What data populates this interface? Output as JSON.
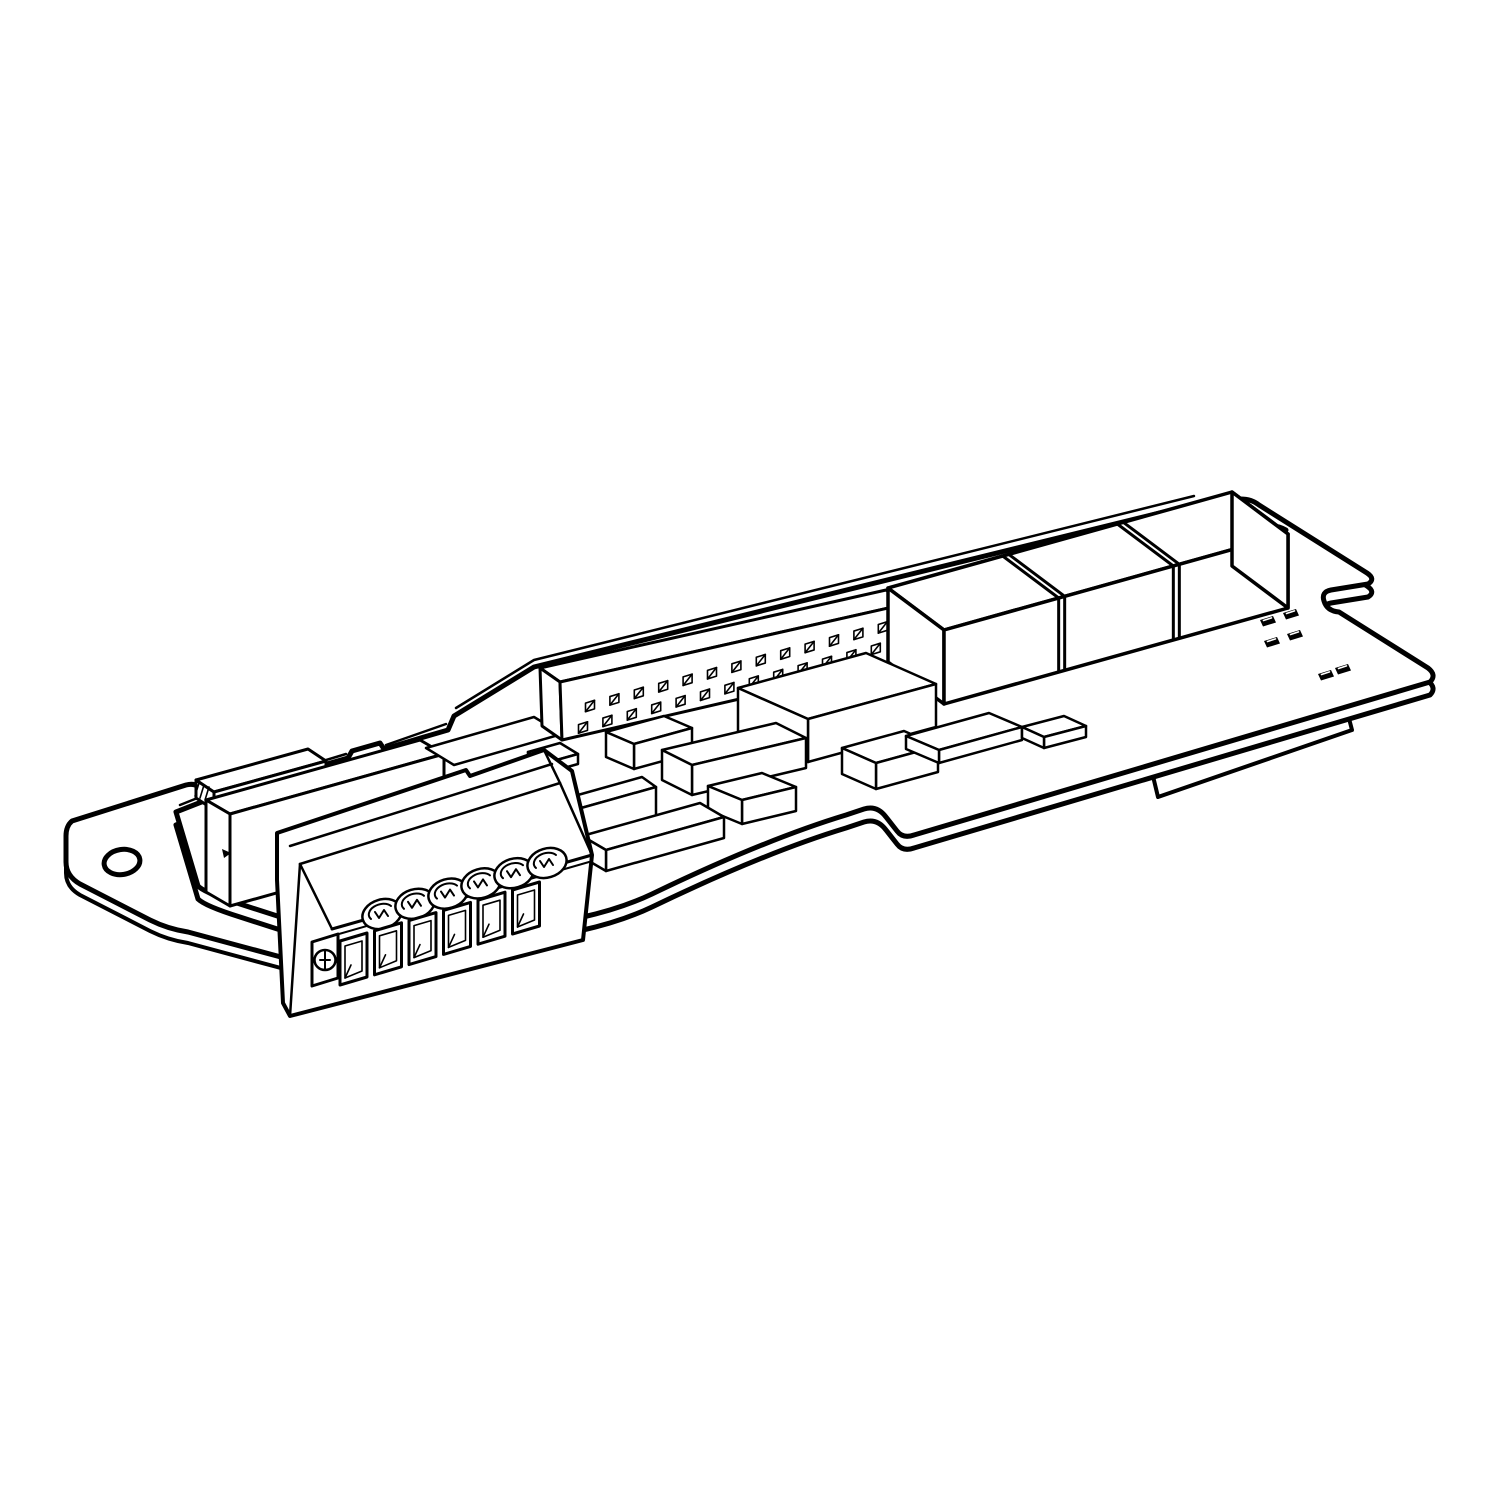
{
  "canvas": {
    "width": 1500,
    "height": 1500,
    "background": "#ffffff"
  },
  "drawing": {
    "type": "technical-line-illustration",
    "subject": "Plug-in option card: printed circuit board with screw terminal block, dual-row pin header, component row and mounting ear",
    "stroke_color": "#000000",
    "fill_color": "#ffffff"
  },
  "parts": {
    "board": {
      "label": "pcb-board",
      "mounting_holes": 2,
      "edge_notches": 2,
      "bottom_edge_tab": 1
    },
    "mounting_ear": {
      "label": "mounting-ear",
      "hole_count": 1
    },
    "terminal_block": {
      "label": "screw-terminal-block",
      "screw_count": 6,
      "window_count": 6,
      "release_screw_count": 1
    },
    "pin_header": {
      "label": "dual-row-pin-header",
      "rows": 2,
      "columns": 13
    },
    "component_row": {
      "label": "relay-component-row",
      "count": 3
    },
    "smd_chips": {
      "label": "smd-components",
      "count": 10
    },
    "silkscreen_marks": {
      "label": "silkscreen-marks",
      "positions": [
        [
          1260,
          620
        ],
        [
          1283,
          613
        ],
        [
          1264,
          641
        ],
        [
          1287,
          634
        ],
        [
          1318,
          674
        ],
        [
          1335,
          668
        ]
      ]
    }
  }
}
